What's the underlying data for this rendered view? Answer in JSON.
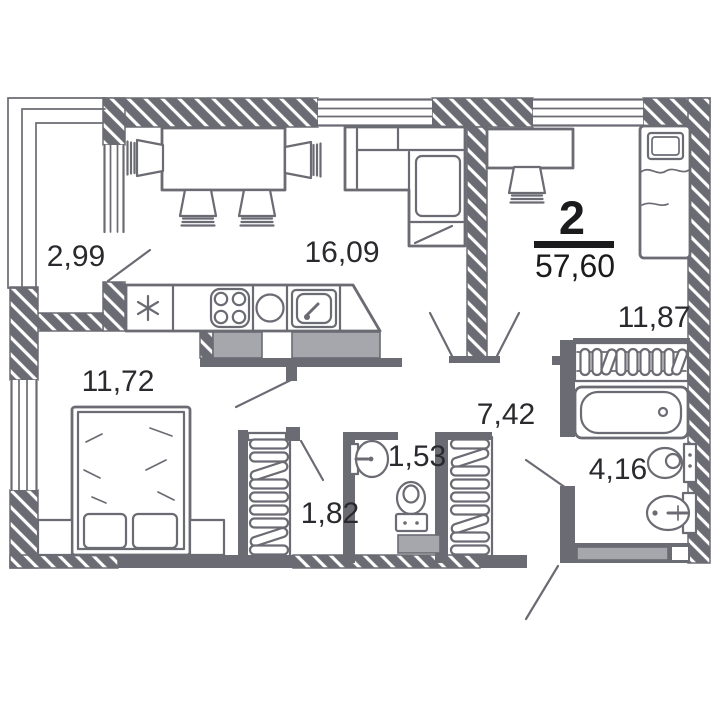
{
  "plan": {
    "summary": {
      "rooms_count": "2",
      "total_area": "57,60"
    },
    "areas": {
      "balcony": "2,99",
      "living_kitchen": "16,09",
      "bedroom": "11,72",
      "child_room": "11,87",
      "hall": "7,42",
      "wardrobe": "1,82",
      "wc": "1,53",
      "bathroom": "4,16"
    }
  },
  "colors": {
    "wall": "#6b6b73",
    "light_fill": "#a6a6ad",
    "label_text": "#2a2a2e",
    "summary_text": "#1b1b1e",
    "background": "#ffffff"
  }
}
